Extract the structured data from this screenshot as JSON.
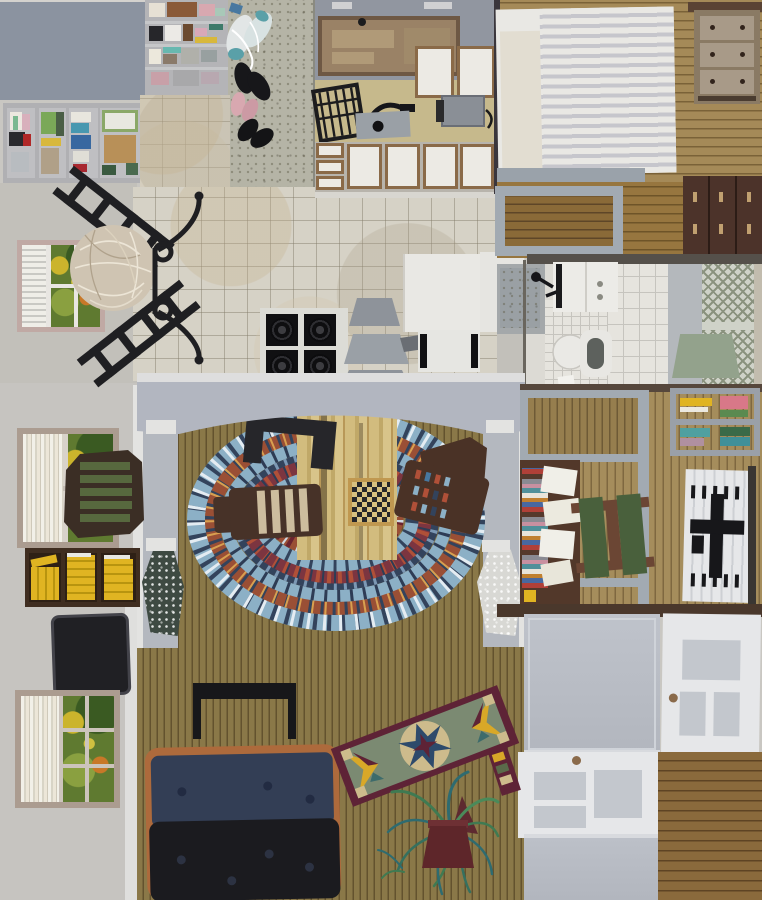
{
  "artwork": {
    "title": "Interior collage painting (flattened house plan view)",
    "medium": "gouache and cut-paper collage look, no text visible",
    "regions": [
      "closet-shelves-top-left",
      "clothes-panel-row",
      "shoe-floor-concrete",
      "doormat",
      "kitchen-counters",
      "microwave-cabinet",
      "dish-rack",
      "stove-top",
      "step-stool",
      "kitchen-marble-floor",
      "bedroom-striped-bed",
      "three-drawer-dresser",
      "wood-deck-with-gray-frame",
      "dark-wardrobe",
      "bathroom-sink",
      "toilet",
      "shower-stall",
      "lattice-panel",
      "sage-bath-mat",
      "dining-corner-window",
      "black-chair-silhouettes",
      "wicker-sphere",
      "living-room-arch",
      "braided-oval-rug",
      "game-table-with-checkerboard",
      "wood-plank-floor",
      "stone-vases",
      "yellow-book-shelf",
      "black-tv",
      "foliage-windows",
      "navy-black-sofa-with-orange-throw",
      "black-console-table",
      "star-quilt-runner",
      "spider-plant",
      "office-desk-with-books",
      "green-cushion-chair",
      "wall-book-shelf",
      "white-rug-with-black-chair",
      "gray-flat-doors",
      "white-paneled-doors",
      "bottom-wood-floor"
    ]
  },
  "palette": {
    "wall": "#c9c7c2",
    "wall-2": "#c2c0ba",
    "wall-3": "#c6c4c0",
    "slate": "#8b93a0",
    "panel-bg": "#b4b4b7",
    "concrete": "#b5b4a6",
    "marble": "#d6d2c6",
    "counter-gray": "#9196a0",
    "counter-tan": "#c6b98c",
    "cab-brown": "#9a8266",
    "cab-frame": "#6e5844",
    "cab-trim": "#8a6a48",
    "white-door": "#eceae4",
    "divider": "#3a363c",
    "bedwood": "#a58a58",
    "bedwood-gap": "#7a6238",
    "bed-white": "#e9e8e4",
    "bed-stripe": "#c6c6cc",
    "pillow": "#e2ddd1",
    "dresser": "#a89a88",
    "dresser-frame": "#8a7a64",
    "deckwood": "#97763f",
    "deckwood-gap": "#6e5428",
    "frame-gray": "#a2aab2",
    "wardrobe": "#4c332a",
    "bath-floor": "#dcdad4",
    "tile-line": "#c6c4be",
    "lattice-bg": "#cfd2c8",
    "lattice-line": "#8a927e",
    "sage": "#93a28c",
    "livingwood": "#8a7848",
    "livingwood-gap": "#63522e",
    "officewood": "#a58d5c",
    "officewood-gap": "#7e6840",
    "bottomwood": "#8a6a3c",
    "bottomwood-gap": "#5e4424",
    "beam": "#b2b6c0",
    "pillar": "#b4b8bf",
    "col-white": "#e3e3e1",
    "rug-blue": "#8cb0c6",
    "rug-rust": "#9a4f35",
    "rug-navy": "#33435c",
    "rug-maroon": "#7c3540",
    "table-wood": "#cdb878",
    "chair-brown": "#473228",
    "ink": "#1e1e20",
    "desk-brown": "#52382a",
    "cushion-green": "#49603c",
    "door-gray": "#b9bdc5",
    "door-white": "#e6e7e9",
    "panel-inset": "#c3c7cd",
    "knob": "#8a6a4a",
    "sofa-navy": "#333e55",
    "sofa-black": "#1b1b1f",
    "sofa-orange": "#ad6a3c",
    "book-yellow": "#e0b422",
    "shelf-dark": "#3f2d20",
    "tv": "#202024",
    "frame-tan": "#ab9c90",
    "frame-pink": "#c0a9a4",
    "blind-white": "#efeee8",
    "blind-line": "#c9c9c4",
    "quilt-maroon": "#5e2336",
    "quilt-sage": "#7b8a72",
    "quilt-tan": "#cdbb8c",
    "quilt-navy": "#2e4a6b",
    "quilt-yellow": "#d8a828",
    "foliage-yellow": "#cbb42c",
    "foliage-orange": "#c87828",
    "plant-green": "#3f7a52",
    "plant-teal": "#2e6b70",
    "pot": "#5e262a",
    "terr-dark": "#3e4a42",
    "terr-light": "#d8d8d4",
    "arch-white": "#dedede"
  }
}
